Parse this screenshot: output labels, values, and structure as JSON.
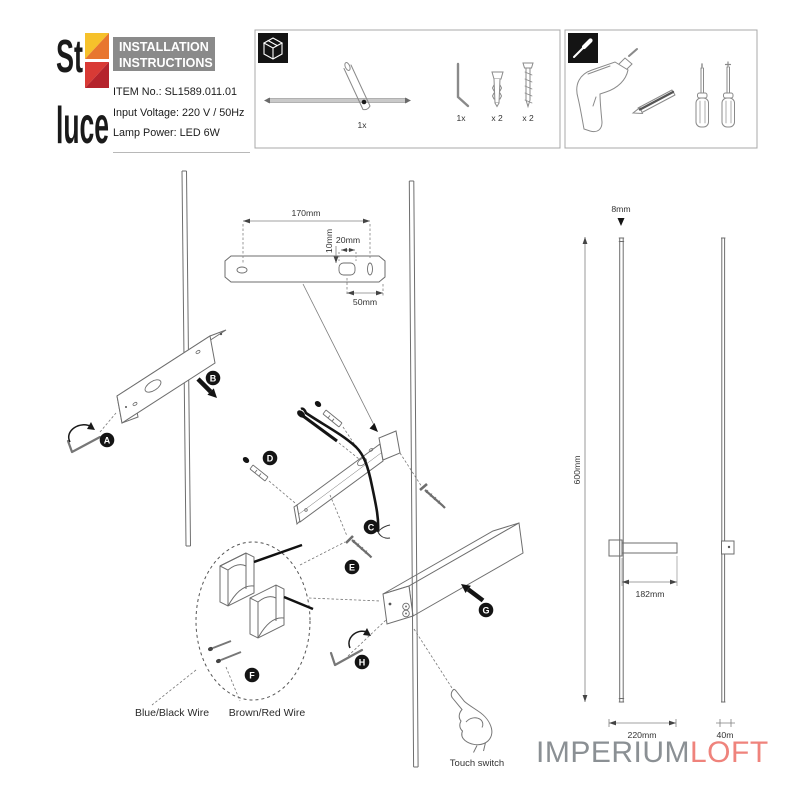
{
  "header": {
    "logo_top": "St",
    "logo_bottom": "luce",
    "title_line1": "INSTALLATION",
    "title_line2": "INSTRUCTIONS",
    "item_no": "ITEM No.: SL1589.011.01",
    "input_voltage": "Input Voltage: 220 V / 50Hz",
    "lamp_power": "Lamp Power: LED 6W"
  },
  "parts": {
    "lamp_qty": "1x",
    "allen_key_qty": "1x",
    "anchors_qty": "x 2",
    "screws_qty": "x 2"
  },
  "dims": {
    "d170": "170mm",
    "d10": "10mm",
    "d20": "20mm",
    "d50": "50mm",
    "d8": "8mm",
    "d600": "600mm",
    "d182": "182mm",
    "d220": "220mm",
    "d40": "40m"
  },
  "steps": {
    "a": "A",
    "b": "B",
    "c": "C",
    "d": "D",
    "e": "E",
    "f": "F",
    "g": "G",
    "h": "H"
  },
  "labels": {
    "blue_black_wire": "Blue/Black Wire",
    "brown_red_wire": "Brown/Red Wire",
    "touch_switch": "Touch switch"
  },
  "watermark": {
    "part1": "IMPERIUM",
    "part2": "LOFT"
  },
  "colors": {
    "title_bg": "#8a8a8a",
    "logo_yellow": "#f6c12b",
    "logo_orange": "#e8762e",
    "logo_red": "#d93a35",
    "logo_crimson": "#b5232c",
    "watermark_gray": "#8b9094",
    "watermark_red": "#ef837c",
    "line_gray": "#6e6e6e"
  }
}
